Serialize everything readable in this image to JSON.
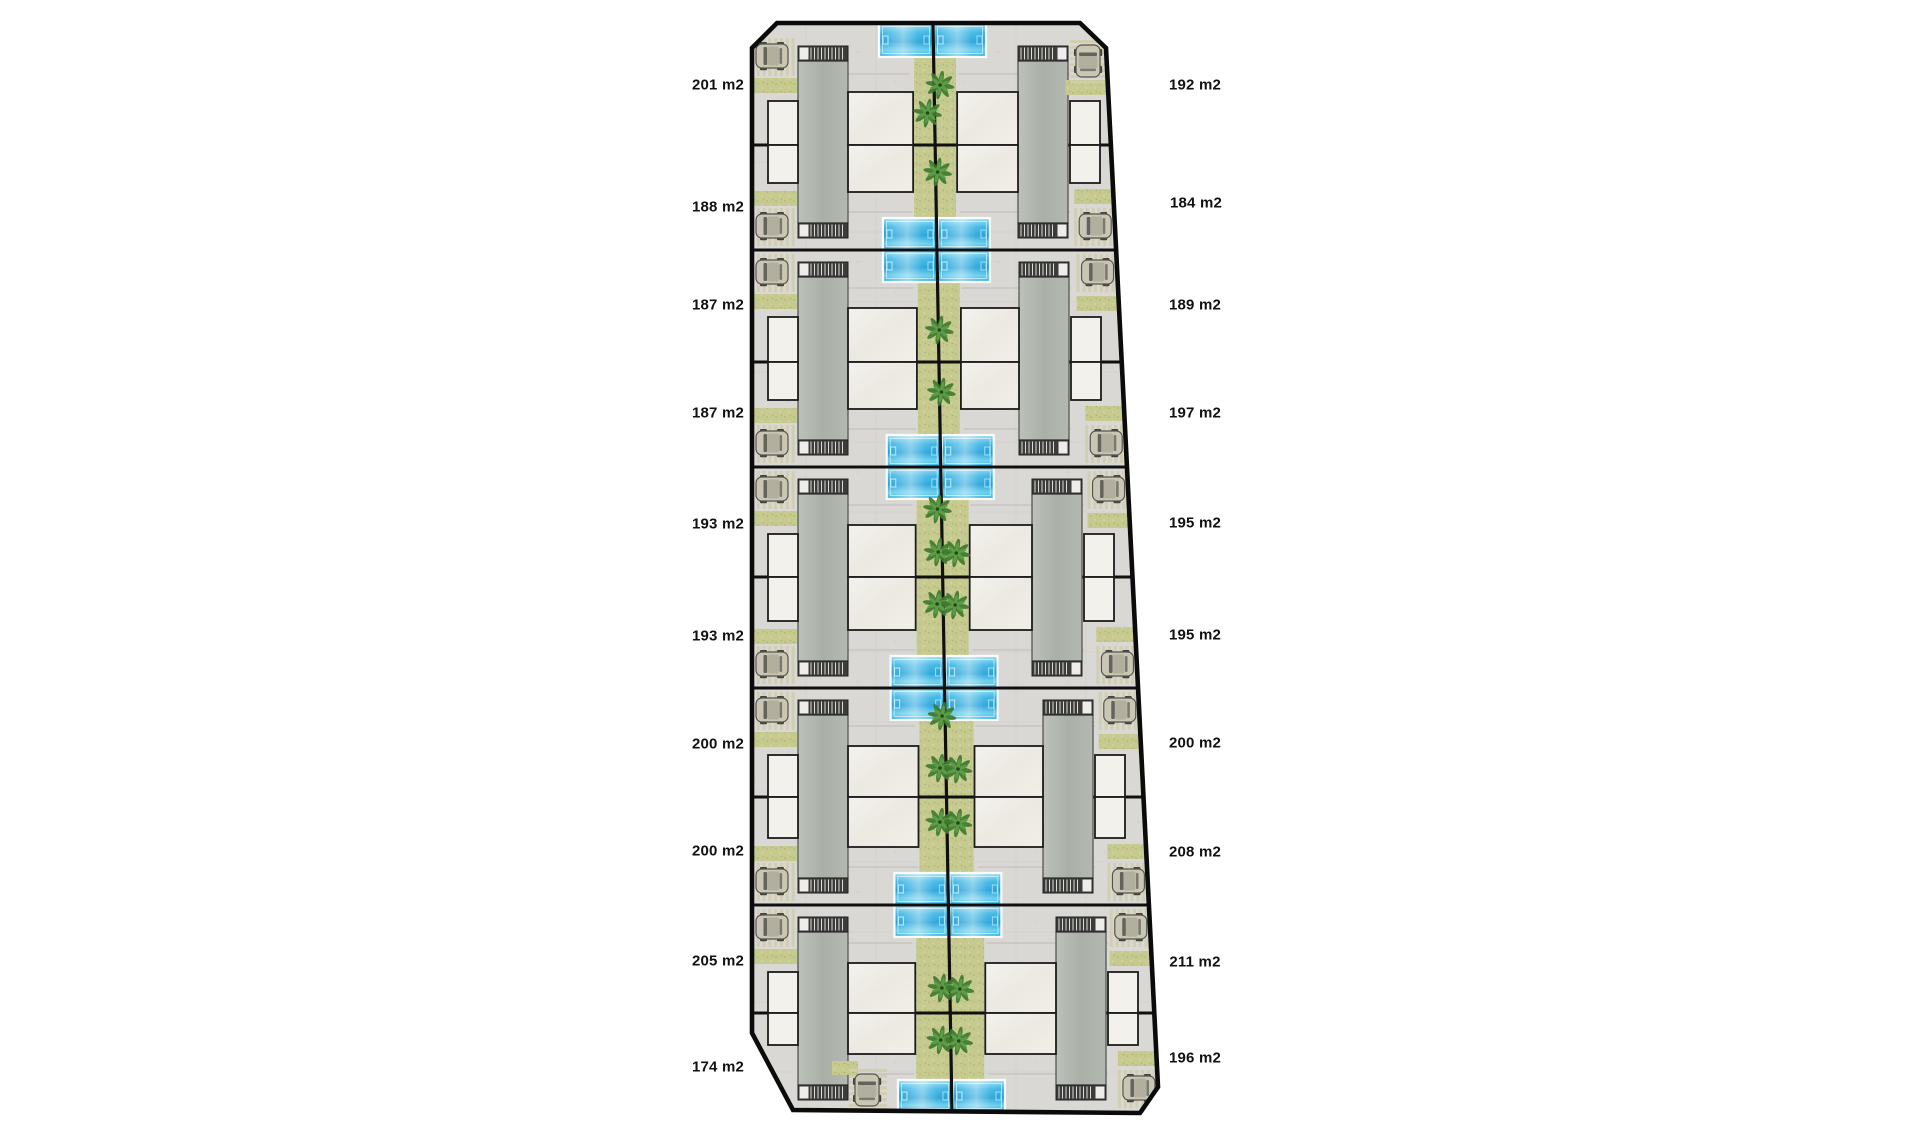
{
  "site_plan": {
    "left_plots": [
      "201 m2",
      "188 m2",
      "187 m2",
      "187 m2",
      "193 m2",
      "193 m2",
      "200 m2",
      "200 m2",
      "205 m2",
      "174 m2"
    ],
    "right_plots": [
      "192 m2",
      "184 m2",
      "189 m2",
      "197 m2",
      "195 m2",
      "195 m2",
      "200 m2",
      "208 m2",
      "211 m2",
      "196 m2"
    ],
    "icons": {
      "car": "car-icon",
      "palm_tree": "palm-tree-icon",
      "pool": "swimming-pool",
      "stairs": "stairs-icon"
    },
    "colors": {
      "pool_blue": "#2fb2e2",
      "grass_green": "#c6ca8f",
      "paving_gray": "#d9d8d4",
      "roof_gray": "#b1b6ae",
      "terrace_white": "#f2f0ea",
      "boundary_black": "#0d0d0d",
      "label_text": "#111111",
      "background": "#ffffff"
    }
  }
}
